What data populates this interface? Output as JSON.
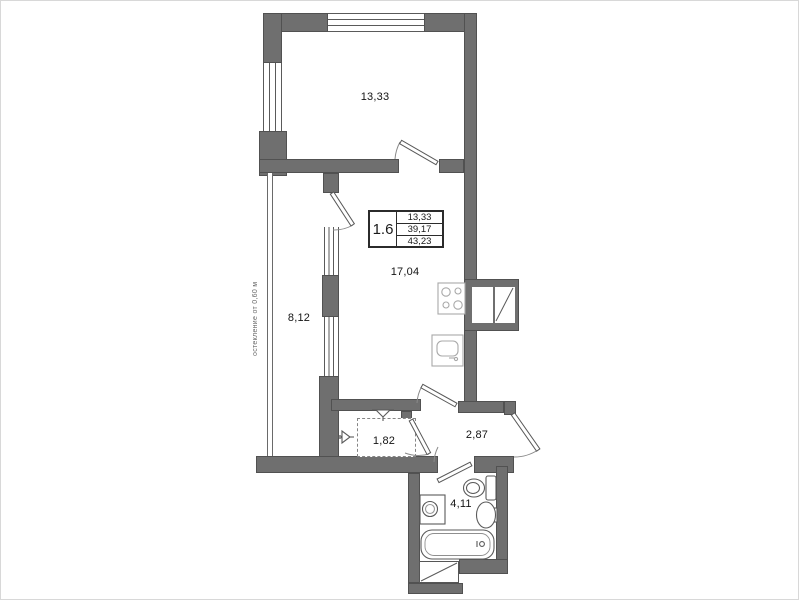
{
  "plan": {
    "glazing_note": "остекление от 0,60 м",
    "info_box": {
      "unit_label": "1.6",
      "rows": [
        "13,33",
        "39,17",
        "43,23"
      ]
    },
    "rooms": {
      "living_room": "13,33",
      "kitchen_living": "17,04",
      "balcony": "8,12",
      "wardrobe": "1,82",
      "hallway": "2,87",
      "bathroom": "4,11"
    },
    "colors": {
      "wall": "#6f6f6f",
      "line": "#5a5a5a",
      "light_fixture": "#a8a8a8",
      "background": "#ffffff"
    },
    "icons": {
      "stove": "stove-icon",
      "kitchen_sink": "kitchen-sink-icon",
      "vent_shaft": "vent-shaft-icon",
      "toilet": "toilet-icon",
      "washbasin": "washbasin-icon",
      "washing_machine": "washing-machine-icon",
      "bathtub": "bathtub-icon",
      "bath_shaft": "bath-shaft-icon",
      "antenna": "antenna-icon",
      "wardrobe_box": "wardrobe-icon"
    }
  }
}
